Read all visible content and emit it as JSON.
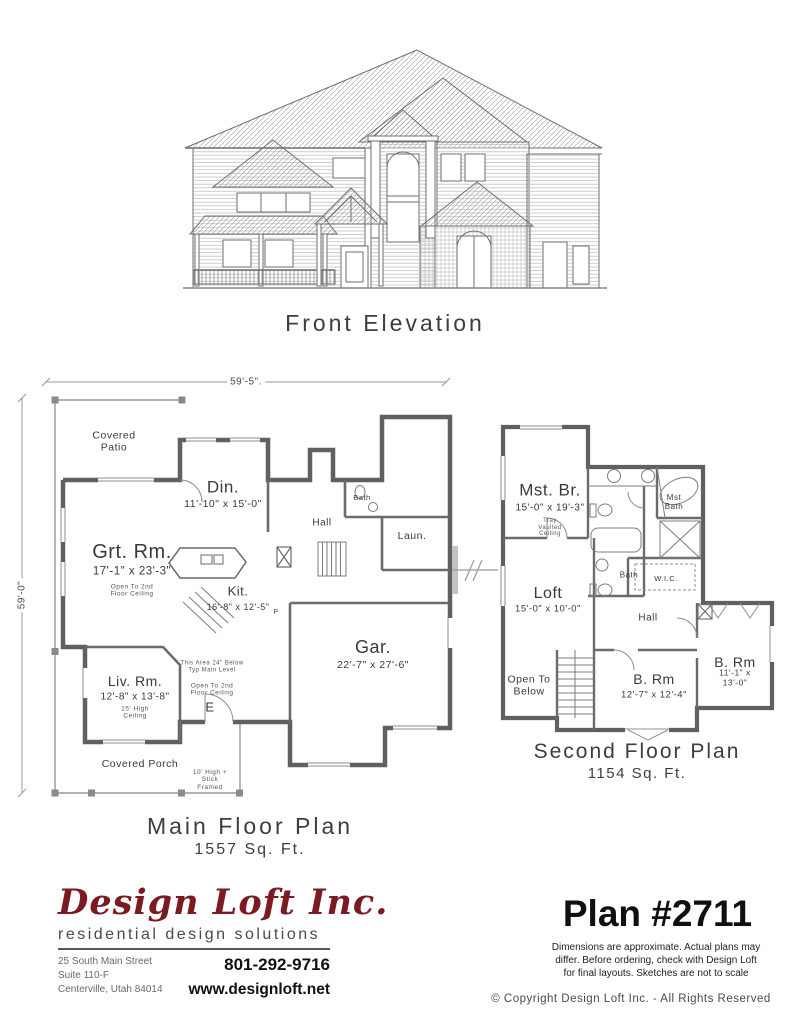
{
  "elevation": {
    "caption": "Front Elevation"
  },
  "main_floor": {
    "caption": "Main Floor Plan",
    "area": "1557 Sq. Ft.",
    "dim_width": "59'-5\".",
    "dim_height": "59'-0\"",
    "labels": {
      "covered_patio": "Covered\nPatio",
      "din_name": "Din.",
      "din_dims": "11'-10\" x 15'-0\"",
      "grt_name": "Grt. Rm.",
      "grt_dims": "17'-1\" x 23'-3\"",
      "grt_note": "Open To 2nd\nFloor Ceiling",
      "hall": "Hall",
      "bath": "Bath",
      "laun": "Laun.",
      "kit_name": "Kit.",
      "kit_dims": "16'-8\" x 12'-5\"",
      "gar_name": "Gar.",
      "gar_dims": "22'-7\" x 27'-6\"",
      "liv_name": "Liv. Rm.",
      "liv_dims": "12'-8\" x 13'-8\"",
      "liv_note": "15' High\nCeiling",
      "area_note": "This Area 24\" Below\nTyp Main Level",
      "open_note": "Open To 2nd\nFloor Ceiling",
      "door_e": "E",
      "pantry": "P",
      "covered_porch": "Covered Porch",
      "stick_note": "10' High +\nStick\nFramed"
    }
  },
  "second_floor": {
    "caption": "Second Floor Plan",
    "area": "1154 Sq. Ft.",
    "labels": {
      "mst_name": "Mst. Br.",
      "mst_dims": "15'-0\" x 19'-3\"",
      "mst_note": "Tray\nVaulted\nCeiling",
      "mst_bath": "Mst\nBath",
      "wic": "W.I.C.",
      "bath": "Bath",
      "loft_name": "Loft",
      "loft_dims": "15'-0\" x 10'-0\"",
      "hall": "Hall",
      "open_below": "Open To\nBelow",
      "brm1_name": "B. Rm",
      "brm1_dims": "12'-7\" x 12'-4\"",
      "brm2_name": "B. Rm",
      "brm2_dims": "11'-1\" x 13'-0\""
    }
  },
  "footer": {
    "company": "Design Loft Inc.",
    "tagline": "residential design solutions",
    "address_line1": "25 South Main Street",
    "address_line2": "Suite 110-F",
    "address_line3": "Centerville, Utah 84014",
    "phone": "801-292-9716",
    "website": "www.designloft.net",
    "plan_number": "Plan #2711",
    "disclaimer": "Dimensions are approximate.  Actual plans may\ndiffer.  Before ordering, check with Design Loft\nfor final layouts.  Sketches are not to scale",
    "copyright": "© Copyright Design Loft Inc. - All Rights Reserved",
    "brand_color": "#7a1b22"
  }
}
